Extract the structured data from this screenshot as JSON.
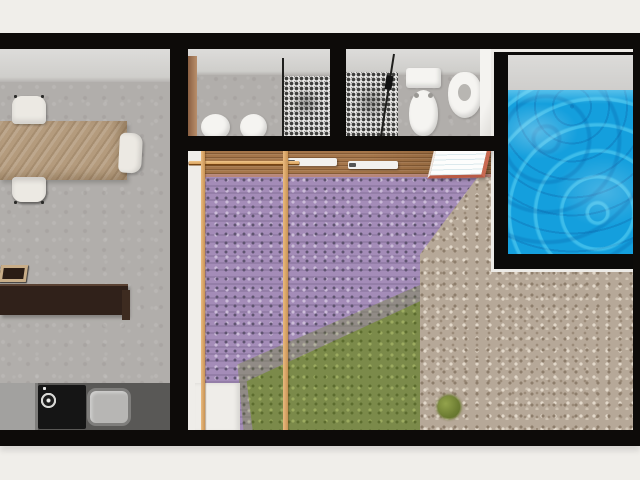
{
  "meta": {
    "scene": "3d-floor-plan-top-view-render",
    "image_width": 640,
    "image_height": 480,
    "visible_text": "none"
  },
  "palette": {
    "background": "#f0eeea",
    "wall": "#0d0b09",
    "concrete": "#b1aeab",
    "table_wood": "#b49b7d",
    "chair": "#ece9e3",
    "island": "#30211a",
    "stool_frame": "#c8ad88",
    "stool_seat": "#2a1c14",
    "counter_light": "#a2a19f",
    "counter_dark": "#595856",
    "stove": "#151515",
    "sink": "#b7b6b4",
    "tile": "#e9e8e6",
    "tile_dot": "#3e3e3c",
    "fixture": "#f5f4f1",
    "door_wood": "#8a5f42",
    "pool_water": "#149fdd",
    "pool_surround": "#eceae6",
    "deck_wood": "#a5764a",
    "pergola": "#d9a360",
    "lavender": "#a48cb8",
    "lavender_dark": "#5f5470",
    "lavender_light": "#cbbcd8",
    "grass": "#7b8a4a",
    "grass_dark": "#5c6c2e",
    "grass_light": "#9cab60",
    "gravel": "#b6a898",
    "gravel_dark": "#8d7d6b",
    "gravel_light": "#e2d8ca",
    "bush": "#6e7e33",
    "lounger": "#f2f1ee",
    "mat_border": "#c96a52",
    "path": "#efede9"
  },
  "rooms": {
    "dining_kitchen": {
      "name": "dining-kitchen-room",
      "dining_chairs_top": 2,
      "dining_chairs_bottom": 2,
      "dining_chairs_end": 1,
      "bar_stools": 3,
      "stove_burners": 4,
      "stove_knobs": 4,
      "sinks": 1
    },
    "bathroom_1": {
      "name": "bathroom-1",
      "round_fixtures": 2,
      "mosaic_shower": 1,
      "glass_partitions": 1
    },
    "bathroom_2": {
      "name": "bathroom-2",
      "toilets": 1,
      "bidets": 1,
      "mosaic_shower": 1,
      "glass_partitions": 1
    },
    "pool": {
      "name": "swimming-pool"
    },
    "garden": {
      "name": "lavender-garden",
      "pergola_beams": 11,
      "pergola_posts": 2,
      "sun_loungers": 2,
      "sun_mats": 1
    },
    "gravel_yard": {
      "name": "gravel-yard",
      "bushes": 4
    }
  }
}
